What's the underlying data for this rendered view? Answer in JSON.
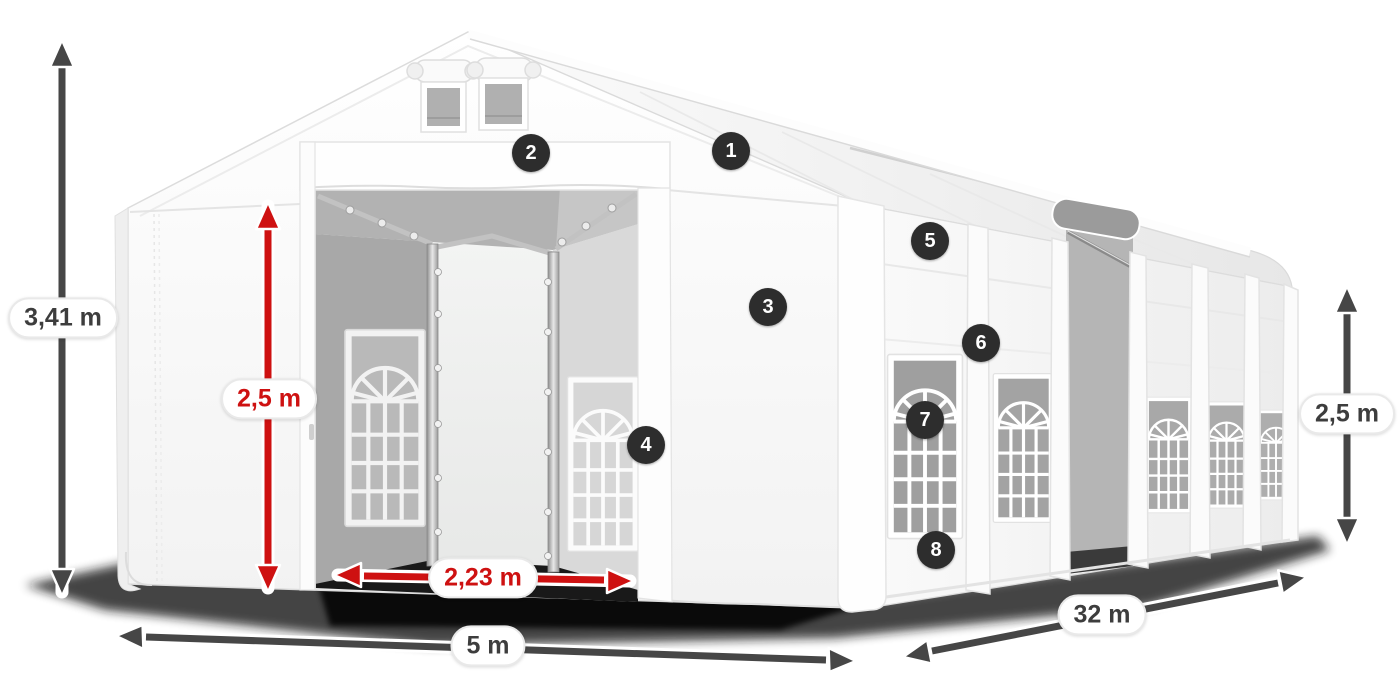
{
  "colors": {
    "accent_red": "#ce1111",
    "arrow_gray": "#464646",
    "badge_background": "#2d2d2d",
    "badge_text": "#ffffff",
    "label_text": "#3d3d3d",
    "pill_background": "#ffffff"
  },
  "dimensions": {
    "total_height": "3,41 m",
    "entrance_height": "2,5 m",
    "entrance_width": "2,23 m",
    "front_width": "5 m",
    "length": "32 m",
    "side_height": "2,5 m"
  },
  "badges": [
    "1",
    "2",
    "3",
    "4",
    "5",
    "6",
    "7",
    "8"
  ]
}
